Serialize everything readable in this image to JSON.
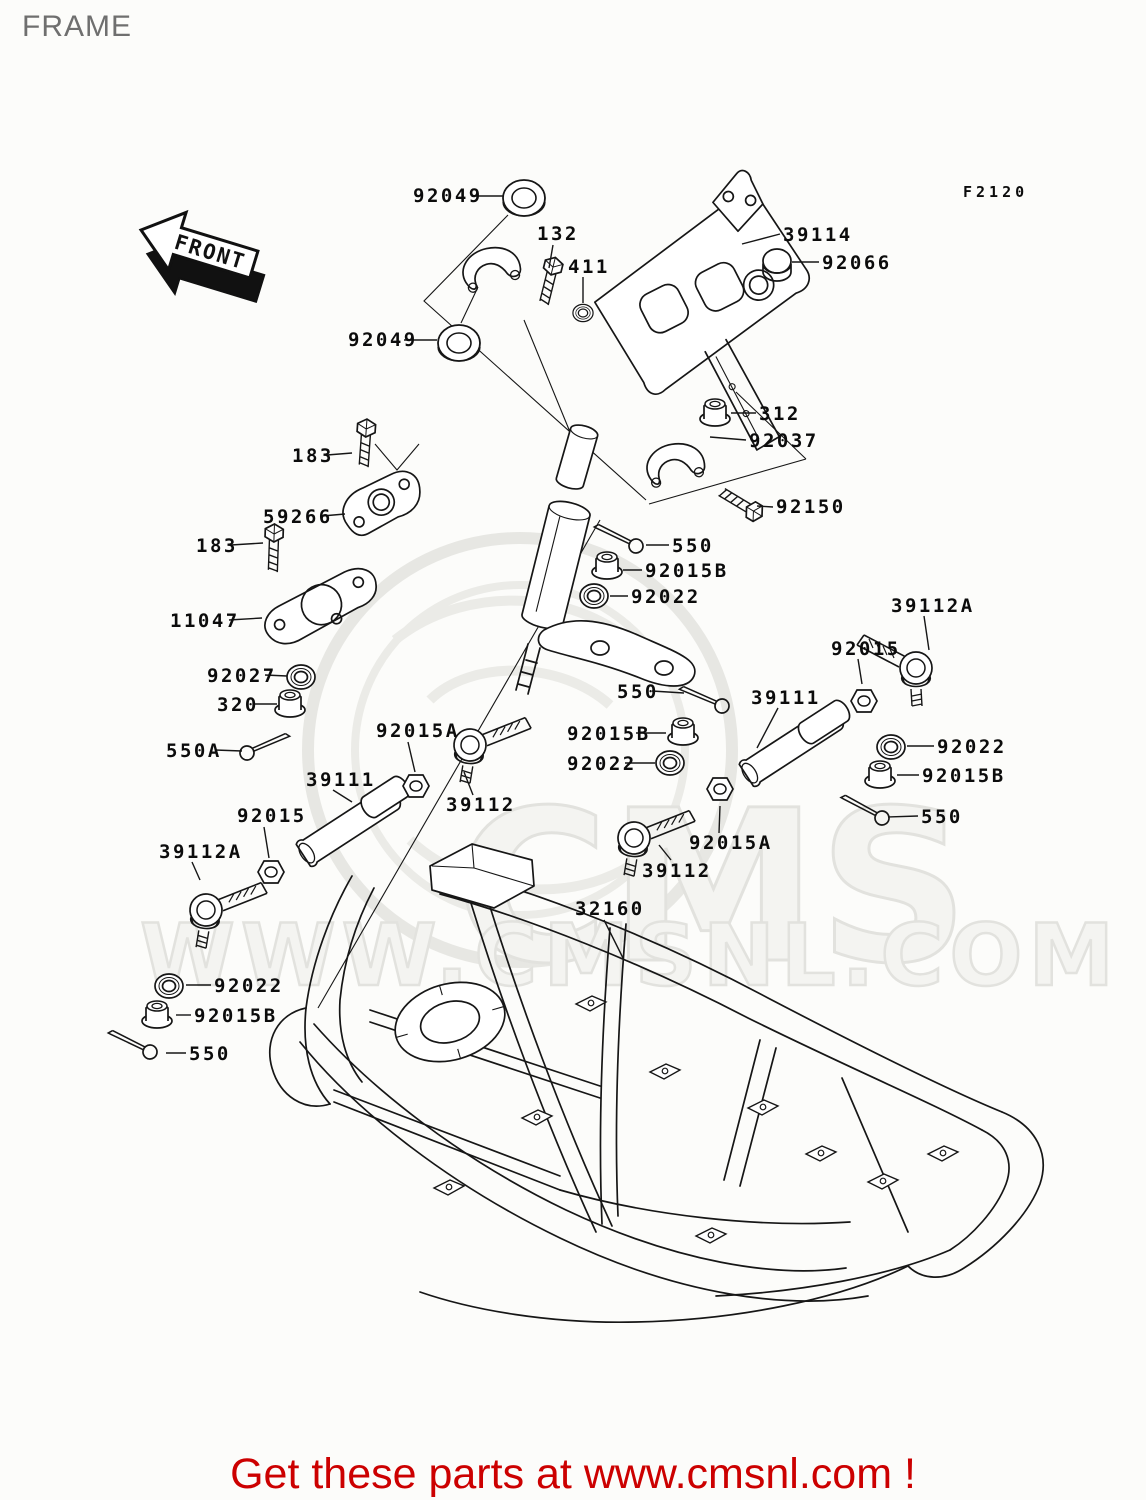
{
  "page": {
    "title": "FRAME",
    "figure_code": "F2120",
    "front_arrow_label": "FRONT",
    "footer": {
      "text": "Get these parts at www.cmsnl.com !",
      "color": "#cc0000"
    },
    "watermark": {
      "logo_text": "CMS",
      "site_text": "WWW.CMSNL.COM"
    },
    "line_color": "#161616",
    "title_color": "#6f6f6f"
  },
  "diagram": {
    "labels": [
      {
        "text": "92049",
        "x": 413,
        "y": 202,
        "leader": [
          472,
          196,
          503,
          196
        ]
      },
      {
        "text": "132",
        "x": 537,
        "y": 240,
        "leader": [
          553,
          245,
          549,
          268
        ]
      },
      {
        "text": "411",
        "x": 568,
        "y": 273,
        "leader": [
          583,
          277,
          583,
          303
        ]
      },
      {
        "text": "39114",
        "x": 783,
        "y": 241,
        "leader": [
          780,
          234,
          742,
          244
        ]
      },
      {
        "text": "92066",
        "x": 822,
        "y": 269,
        "leader": [
          819,
          262,
          792,
          262
        ]
      },
      {
        "text": "92049",
        "x": 348,
        "y": 346,
        "leader": [
          404,
          340,
          437,
          340
        ]
      },
      {
        "text": "312",
        "x": 759,
        "y": 420,
        "leader": [
          756,
          413,
          731,
          413
        ]
      },
      {
        "text": "92037",
        "x": 749,
        "y": 447,
        "leader": [
          746,
          440,
          710,
          437
        ]
      },
      {
        "text": "92150",
        "x": 776,
        "y": 513,
        "leader": [
          773,
          507,
          757,
          506
        ]
      },
      {
        "text": "550",
        "x": 672,
        "y": 552,
        "leader": [
          669,
          545,
          646,
          545
        ]
      },
      {
        "text": "92015B",
        "x": 645,
        "y": 577,
        "leader": [
          642,
          570,
          623,
          570
        ]
      },
      {
        "text": "92022",
        "x": 631,
        "y": 603,
        "leader": [
          628,
          596,
          610,
          596
        ]
      },
      {
        "text": "183",
        "x": 292,
        "y": 462,
        "leader": [
          327,
          455,
          352,
          453
        ]
      },
      {
        "text": "59266",
        "x": 263,
        "y": 523,
        "leader": [
          322,
          516,
          345,
          514
        ]
      },
      {
        "text": "183",
        "x": 196,
        "y": 552,
        "leader": [
          231,
          545,
          263,
          543
        ]
      },
      {
        "text": "11047",
        "x": 170,
        "y": 627,
        "leader": [
          229,
          620,
          262,
          618
        ]
      },
      {
        "text": "92027",
        "x": 207,
        "y": 682,
        "leader": [
          265,
          675,
          287,
          676
        ]
      },
      {
        "text": "320",
        "x": 217,
        "y": 711,
        "leader": [
          253,
          704,
          277,
          704
        ]
      },
      {
        "text": "550A",
        "x": 166,
        "y": 757,
        "leader": [
          215,
          750,
          242,
          751
        ]
      },
      {
        "text": "92015A",
        "x": 376,
        "y": 737,
        "leader": [
          408,
          742,
          415,
          772
        ]
      },
      {
        "text": "39111",
        "x": 306,
        "y": 786,
        "leader": [
          333,
          790,
          352,
          802
        ]
      },
      {
        "text": "39112",
        "x": 446,
        "y": 811,
        "leader": [
          473,
          795,
          464,
          772
        ]
      },
      {
        "text": "92015",
        "x": 237,
        "y": 822,
        "leader": [
          264,
          827,
          269,
          858
        ]
      },
      {
        "text": "39112A",
        "x": 159,
        "y": 858,
        "leader": [
          192,
          862,
          200,
          880
        ]
      },
      {
        "text": "92022",
        "x": 214,
        "y": 992,
        "leader": [
          211,
          985,
          186,
          985
        ]
      },
      {
        "text": "92015B",
        "x": 194,
        "y": 1022,
        "leader": [
          191,
          1015,
          176,
          1015
        ]
      },
      {
        "text": "550",
        "x": 189,
        "y": 1060,
        "leader": [
          186,
          1053,
          166,
          1053
        ]
      },
      {
        "text": "550",
        "x": 617,
        "y": 698,
        "leader": [
          652,
          691,
          684,
          693
        ]
      },
      {
        "text": "92015B",
        "x": 567,
        "y": 740,
        "leader": [
          636,
          733,
          666,
          733
        ]
      },
      {
        "text": "92022",
        "x": 567,
        "y": 770,
        "leader": [
          625,
          763,
          655,
          763
        ]
      },
      {
        "text": "39111",
        "x": 751,
        "y": 704,
        "leader": [
          778,
          708,
          757,
          748
        ]
      },
      {
        "text": "92015A",
        "x": 689,
        "y": 849,
        "leader": [
          719,
          833,
          720,
          806
        ]
      },
      {
        "text": "39112",
        "x": 642,
        "y": 877,
        "leader": [
          671,
          860,
          659,
          845
        ]
      },
      {
        "text": "39112A",
        "x": 891,
        "y": 612,
        "leader": [
          924,
          616,
          929,
          650
        ]
      },
      {
        "text": "92015",
        "x": 831,
        "y": 655,
        "leader": [
          858,
          659,
          862,
          684
        ]
      },
      {
        "text": "92022",
        "x": 937,
        "y": 753,
        "leader": [
          934,
          746,
          907,
          746
        ]
      },
      {
        "text": "92015B",
        "x": 922,
        "y": 782,
        "leader": [
          919,
          775,
          897,
          775
        ]
      },
      {
        "text": "550",
        "x": 921,
        "y": 823,
        "leader": [
          918,
          816,
          888,
          817
        ]
      },
      {
        "text": "32160",
        "x": 575,
        "y": 915,
        "leader": [
          604,
          920,
          623,
          958
        ]
      }
    ]
  }
}
